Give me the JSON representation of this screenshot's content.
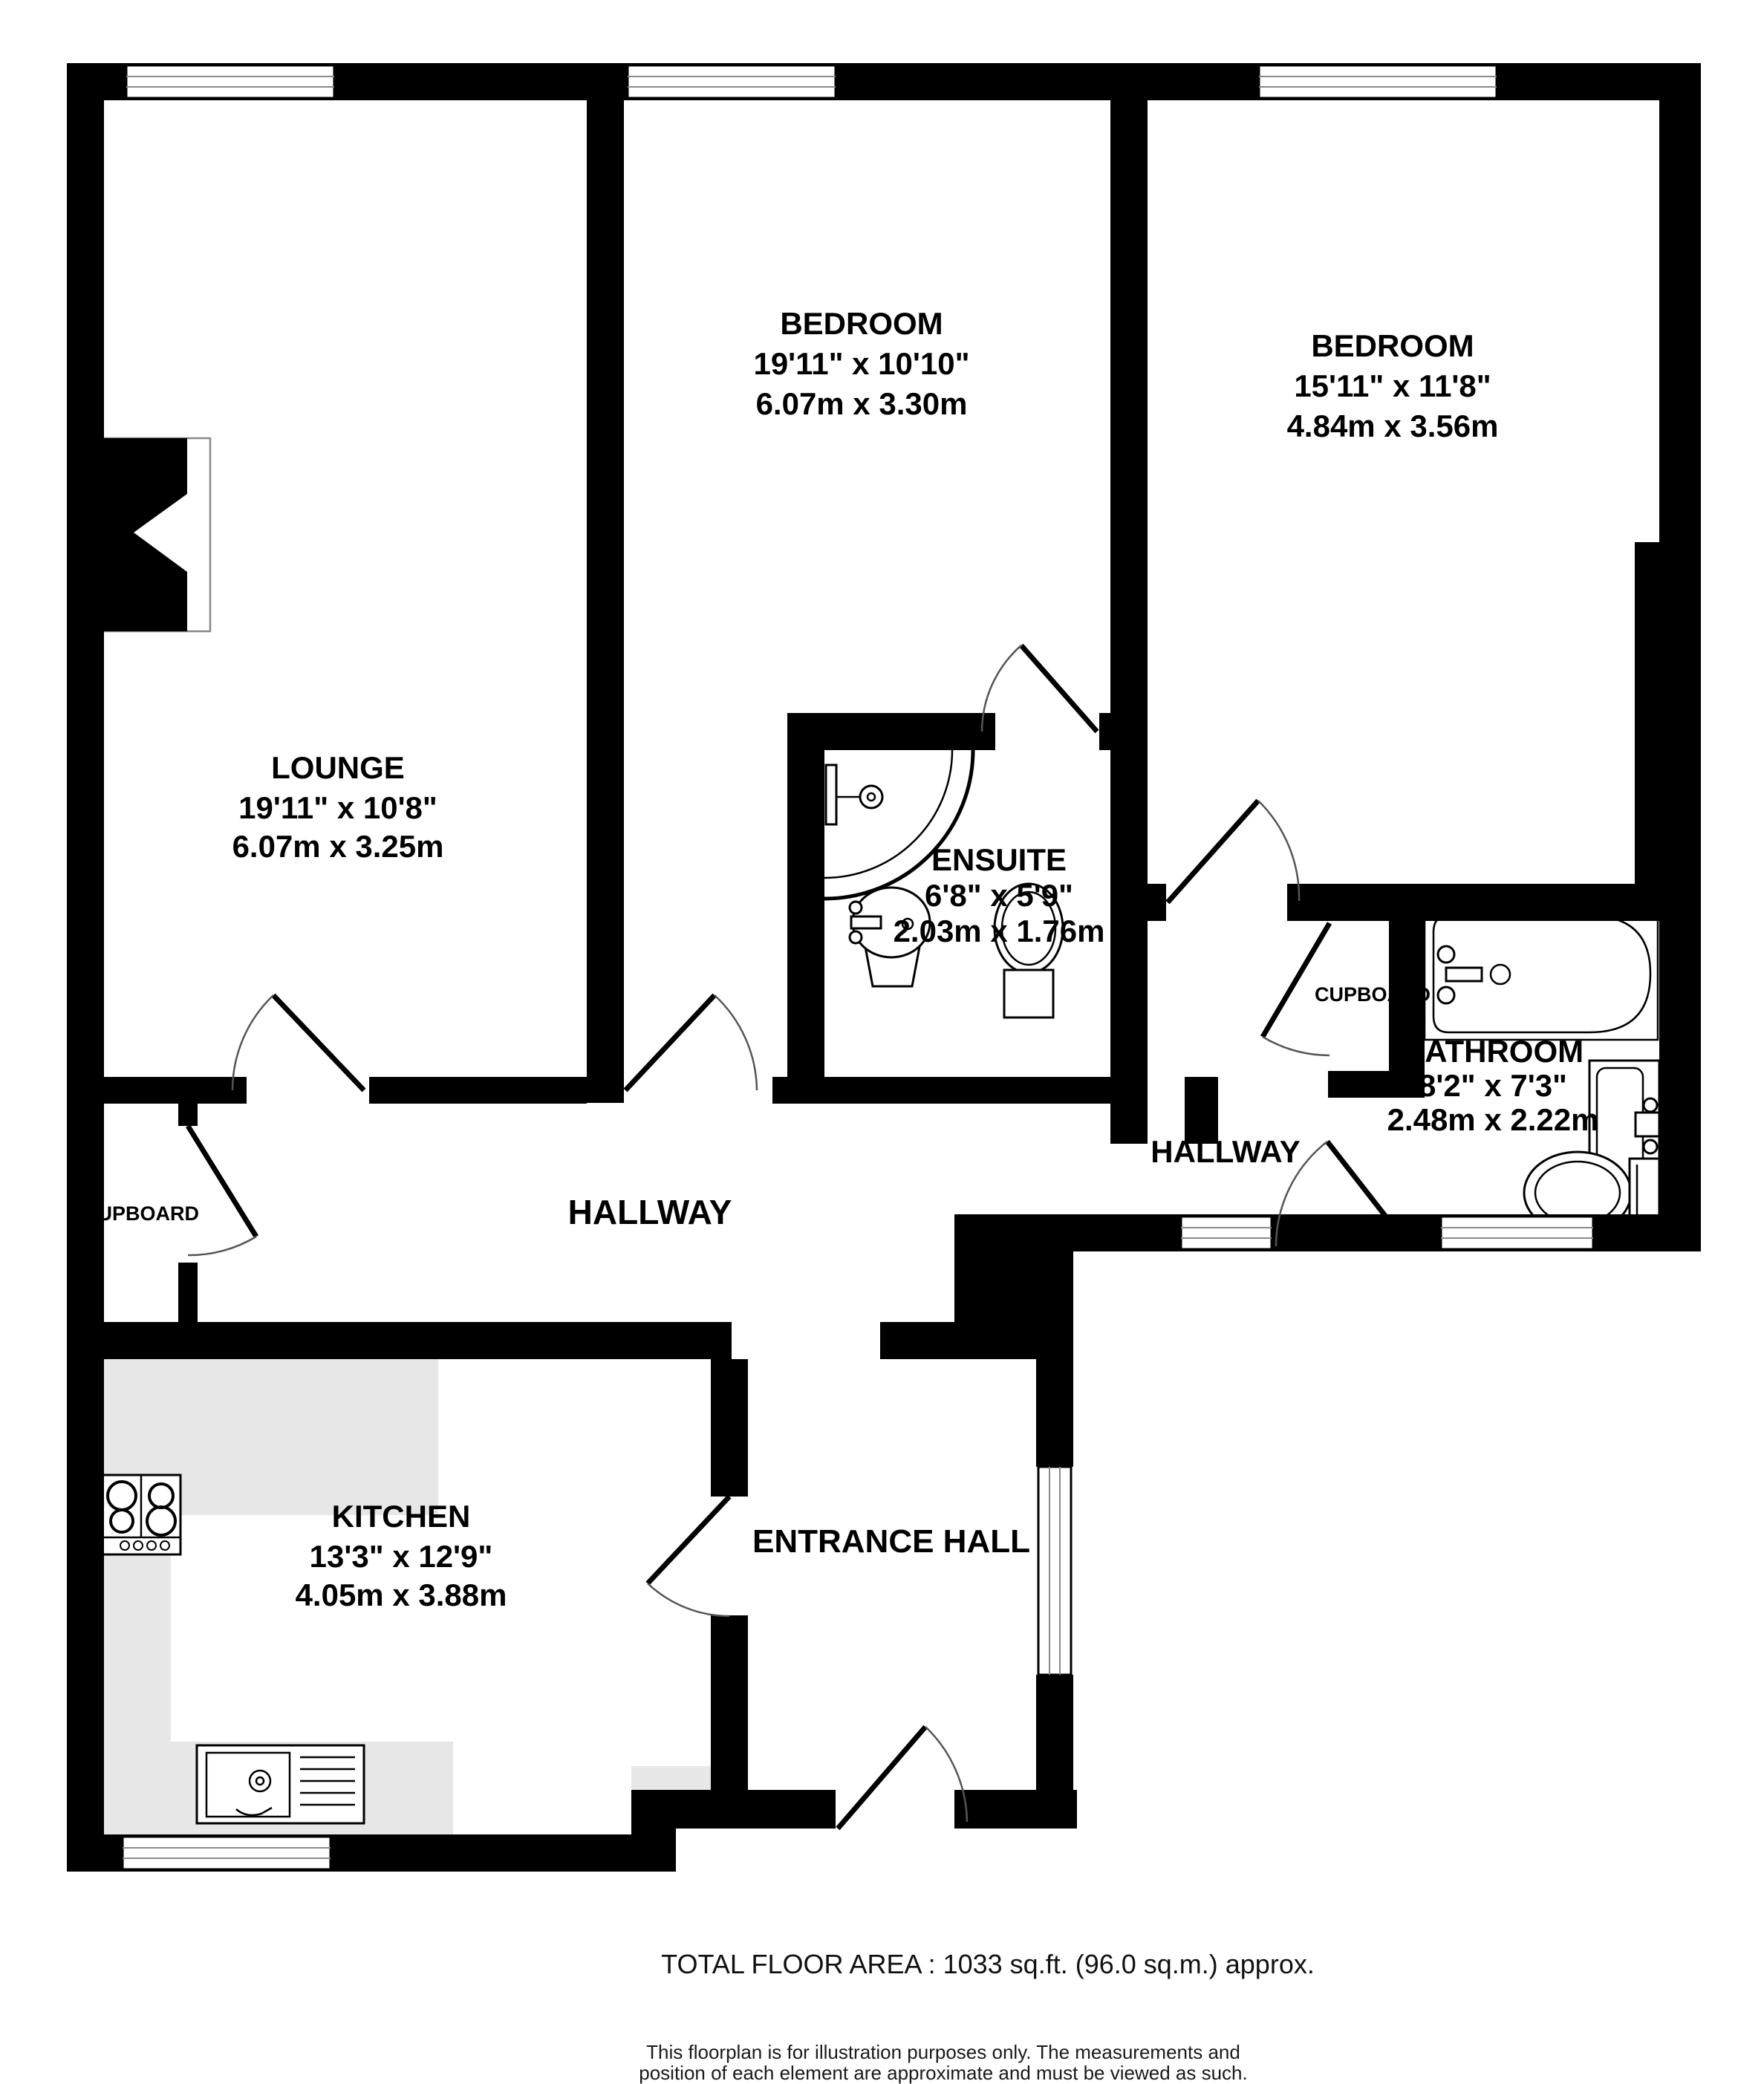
{
  "document": {
    "type": "floorplan",
    "colors": {
      "wall": "#000000",
      "floor": "#ffffff",
      "counter": "#e7e7e7"
    }
  },
  "rooms": [
    {
      "id": "lounge",
      "name": "LOUNGE",
      "imperial": "19'11\"  x 10'8\"",
      "metric": "6.07m  x 3.25m"
    },
    {
      "id": "bedroom1",
      "name": "BEDROOM",
      "imperial": "19'11\"  x 10'10\"",
      "metric": "6.07m  x 3.30m"
    },
    {
      "id": "bedroom2",
      "name": "BEDROOM",
      "imperial": "15'11\"  x 11'8\"",
      "metric": "4.84m  x 3.56m"
    },
    {
      "id": "ensuite",
      "name": "ENSUITE",
      "imperial": "6'8\"  x 5'9\"",
      "metric": "2.03m  x 1.76m"
    },
    {
      "id": "bathroom",
      "name": "BATHROOM",
      "imperial": "8'2\"  x 7'3\"",
      "metric": "2.48m  x 2.22m"
    },
    {
      "id": "kitchen",
      "name": "KITCHEN",
      "imperial": "13'3\"  x 12'9\"",
      "metric": "4.05m  x 3.88m"
    }
  ],
  "areas": {
    "hallway_main": "HALLWAY",
    "hallway_right": "HALLWAY",
    "cupboard_left": "CUPBOARD",
    "cupboard_right": "CUPBOARD",
    "entrance_hall": "ENTRANCE HALL"
  },
  "footer": {
    "total_area": "TOTAL FLOOR AREA : 1033 sq.ft. (96.0 sq.m.) approx.",
    "disclaimer_line1": "This floorplan is for illustration purposes only. The measurements and",
    "disclaimer_line2": "position of each element are approximate and must be viewed as such."
  }
}
